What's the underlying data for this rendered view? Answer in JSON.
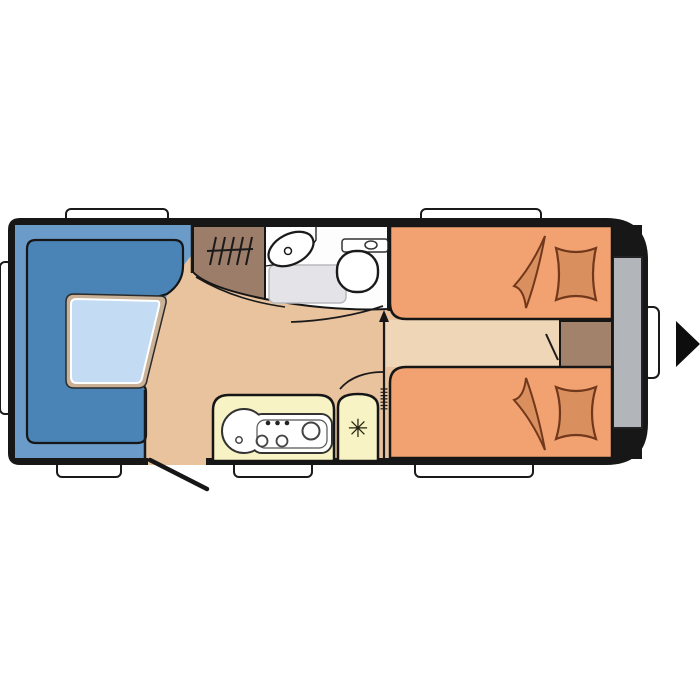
{
  "floorplan": {
    "type": "caravan-floorplan-top-view",
    "colors": {
      "background": "#ffffff",
      "body": "#171717",
      "floor": "#e9c29e",
      "walkway": "#eed6b6",
      "seat_outer": "#6a9bc9",
      "seat_inner": "#4a84b6",
      "table_border": "#c8b196",
      "table_top": "#c3dcf4",
      "wardrobe": "#9c7d6a",
      "washroom": "#fdfdfd",
      "shower_tray": "#e4e4e8",
      "fixture": "#ffffff",
      "kitchen": "#f8f3c5",
      "bed": "#f2a271",
      "bedding": "#d98f5e",
      "bedding_outline": "#71381c",
      "storage_block": "#a2826b",
      "rear_panel": "#b2b5b9",
      "window": "#ffffff",
      "arrow": "#0d0d0d",
      "snowflake": "#23230f"
    },
    "icons": {
      "fridge_snowflake": "✳"
    }
  }
}
